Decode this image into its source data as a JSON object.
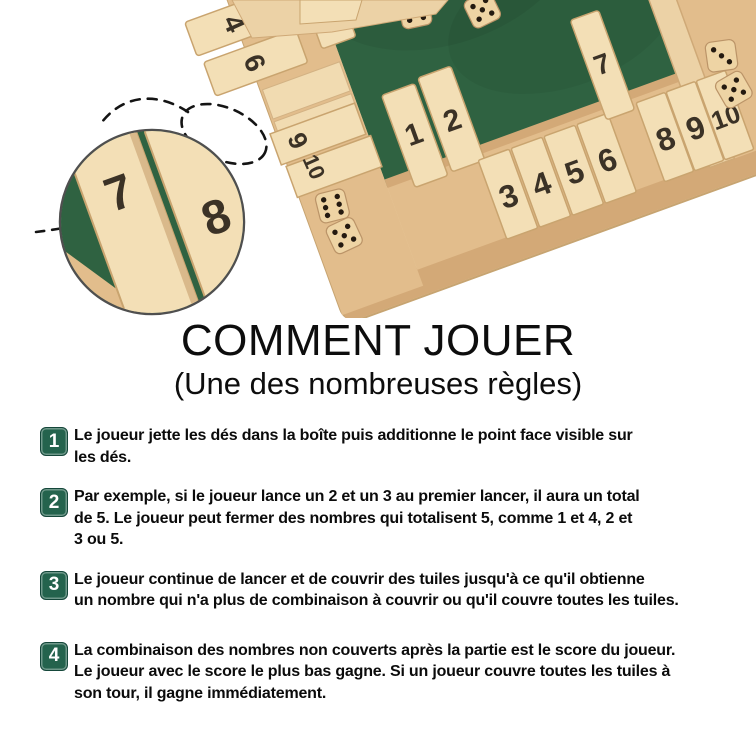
{
  "photo": {
    "alt": "Shut the box wooden game board with numbered tiles and dice",
    "colors": {
      "felt_green": "#2f6241",
      "wood_light": "#ecd2a6",
      "wood_mid": "#e2bd8c",
      "wood_dark": "#d3a977",
      "tile_face": "#f3dfb6",
      "number_brown": "#3b3226",
      "badge_green": "#24634d"
    },
    "board": {
      "left_rail_tiles": [
        "4",
        "6",
        "9",
        "10"
      ],
      "bottom_standing_tiles": [
        "1",
        "2"
      ],
      "bottom_flat_tiles_left": [
        "3",
        "4",
        "5",
        "6"
      ],
      "bottom_standing_tile": "7",
      "bottom_flat_tiles_right": [
        "8",
        "9",
        "10"
      ]
    },
    "inset_tiles": [
      "7",
      "8"
    ]
  },
  "title": {
    "heading": "COMMENT JOUER",
    "subheading": "(Une des nombreuses règles)"
  },
  "steps": [
    {
      "number": "1",
      "lines": [
        "Le joueur jette les dés dans la boîte puis additionne le point face visible sur",
        "les dés."
      ]
    },
    {
      "number": "2",
      "lines": [
        "Par exemple, si le joueur lance un 2 et un 3 au premier lancer, il aura un total",
        "de 5. Le joueur peut fermer des nombres qui totalisent 5, comme 1 et 4, 2 et",
        "3 ou 5."
      ]
    },
    {
      "number": "3",
      "lines": [
        "Le joueur continue de lancer et de couvrir des tuiles jusqu'à ce qu'il obtienne",
        "un nombre qui n'a plus de combinaison à couvrir ou qu'il couvre toutes les tuiles."
      ]
    },
    {
      "number": "4",
      "lines": [
        "La combinaison des nombres non couverts après la partie est le score du joueur.",
        "Le joueur avec le score le plus bas gagne. Si un joueur couvre toutes les tuiles à",
        "son tour, il gagne immédiatement."
      ]
    }
  ]
}
